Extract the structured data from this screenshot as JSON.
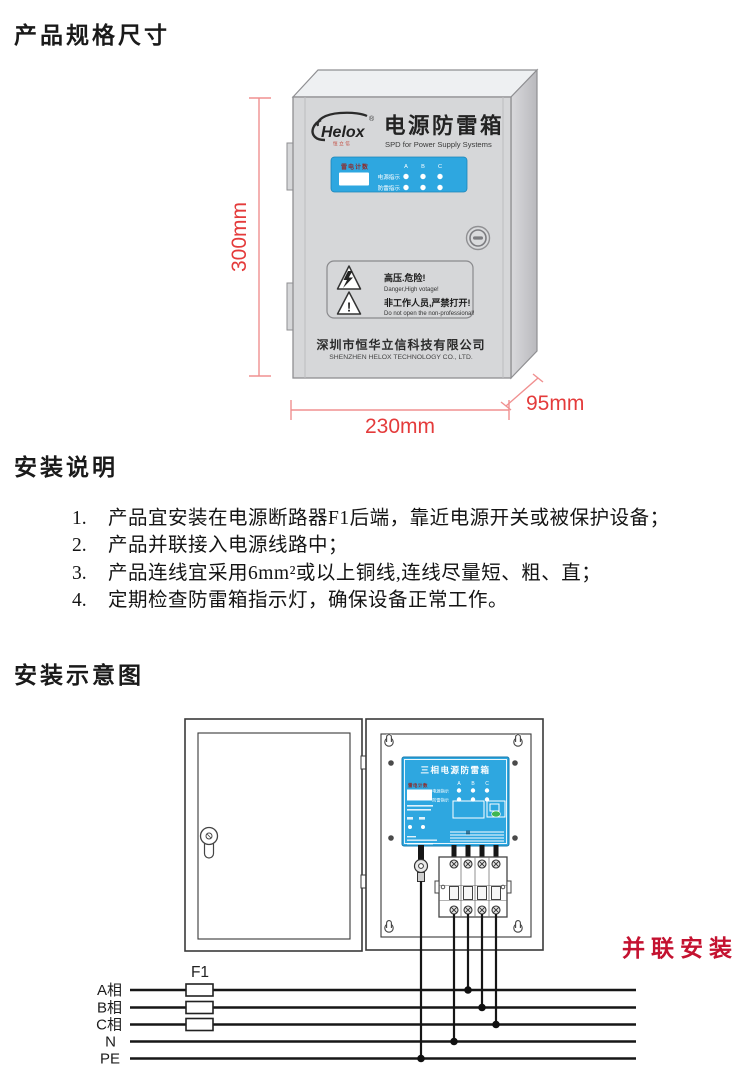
{
  "sections": {
    "spec_title": "产品规格尺寸",
    "install_title": "安装说明",
    "diagram_title": "安装示意图"
  },
  "product": {
    "brand": "Helox",
    "brand_reg": "®",
    "brand_sub": "恒立信",
    "name": "电源防雷箱",
    "name_en": "SPD for Power Supply Systems",
    "panel": {
      "counter_label": "雷电计数",
      "power_label": "电源指示",
      "surge_label": "防雷指示",
      "phases": [
        "A",
        "B",
        "C"
      ]
    },
    "warning": {
      "cn1": "高压.危险!",
      "en1": "Danger,High votage!",
      "cn2": "非工作人员,严禁打开!",
      "en2": "Do not open the non-professional!"
    },
    "company_cn": "深圳市恒华立信科技有限公司",
    "company_en": "SHENZHEN HELOX TECHNOLOGY CO., LTD.",
    "dim_height": "300mm",
    "dim_width": "230mm",
    "dim_depth": "95mm"
  },
  "install_notes": [
    {
      "num": "1.",
      "text": "产品宜安装在电源断路器F1后端，靠近电源开关或被保护设备；"
    },
    {
      "num": "2.",
      "text": "产品并联接入电源线路中；"
    },
    {
      "num": "3.",
      "text": "产品连线宜采用6mm²或以上铜线,连线尽量短、粗、直；"
    },
    {
      "num": "4.",
      "text": "定期检查防雷箱指示灯，确保设备正常工作。"
    }
  ],
  "diagram": {
    "module_title": "三相电源防雷箱",
    "module_counter_label": "雷电计数",
    "module_power_label": "电源指示",
    "module_surge_label": "防雷指示",
    "phases": [
      "A",
      "B",
      "C"
    ],
    "breaker_label": "F1",
    "bus_labels": [
      "A相",
      "B相",
      "C相",
      "N",
      "PE"
    ],
    "parallel_label": "并联安装"
  },
  "colors": {
    "accent_blue": "#2ea7e0",
    "dim_red_text": "#e43b3b",
    "dim_red_line": "#f09090",
    "parallel_red": "#c41230",
    "counter_red": "#8d2d2d"
  }
}
